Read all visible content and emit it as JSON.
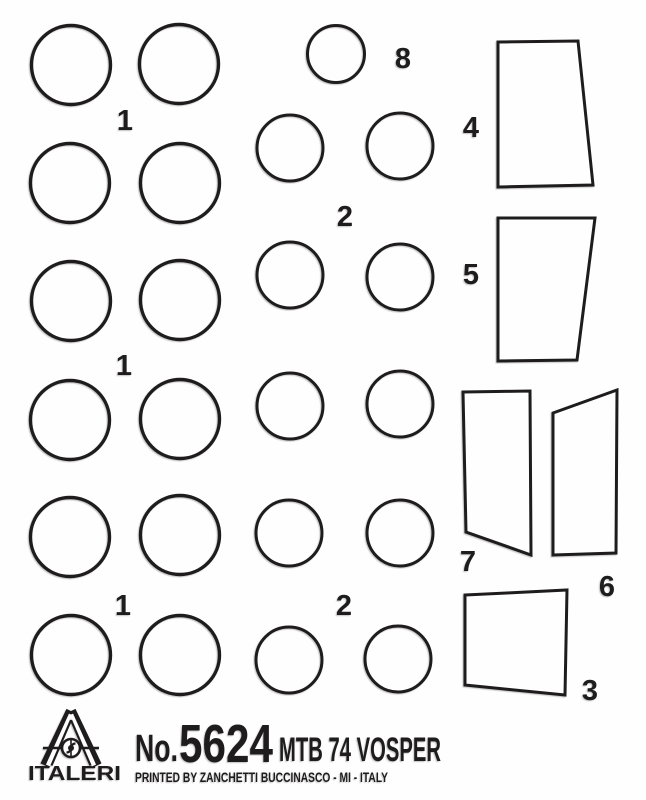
{
  "sheet": {
    "title": "Italeri decal / clear parts placement sheet",
    "background_color": "#fefefe",
    "ink_color": "#1e1c1d"
  },
  "part_labels": [
    {
      "text": "1",
      "x": 125,
      "y": 130
    },
    {
      "text": "1",
      "x": 124,
      "y": 375
    },
    {
      "text": "1",
      "x": 123,
      "y": 615
    },
    {
      "text": "2",
      "x": 345,
      "y": 226
    },
    {
      "text": "2",
      "x": 344,
      "y": 615
    },
    {
      "text": "8",
      "x": 403,
      "y": 68
    },
    {
      "text": "4",
      "x": 471,
      "y": 137
    },
    {
      "text": "5",
      "x": 471,
      "y": 284
    },
    {
      "text": "7",
      "x": 468,
      "y": 571
    },
    {
      "text": "6",
      "x": 607,
      "y": 596
    },
    {
      "text": "3",
      "x": 590,
      "y": 700
    }
  ],
  "circles": [
    {
      "part": "1",
      "cx": 71,
      "cy": 65,
      "r": 39.5,
      "sw": 3.4
    },
    {
      "part": "1",
      "cx": 179,
      "cy": 64,
      "r": 39.5,
      "sw": 3.4
    },
    {
      "part": "1",
      "cx": 70,
      "cy": 183,
      "r": 39.5,
      "sw": 3.4
    },
    {
      "part": "1",
      "cx": 180,
      "cy": 183,
      "r": 39.5,
      "sw": 3.4
    },
    {
      "part": "1",
      "cx": 71,
      "cy": 301,
      "r": 39.5,
      "sw": 3.4
    },
    {
      "part": "1",
      "cx": 180,
      "cy": 300,
      "r": 39.5,
      "sw": 3.4
    },
    {
      "part": "1",
      "cx": 70,
      "cy": 420,
      "r": 39.5,
      "sw": 3.4
    },
    {
      "part": "1",
      "cx": 180,
      "cy": 419,
      "r": 39.5,
      "sw": 3.4
    },
    {
      "part": "1",
      "cx": 70,
      "cy": 537,
      "r": 39.5,
      "sw": 3.4
    },
    {
      "part": "1",
      "cx": 180,
      "cy": 535,
      "r": 39.5,
      "sw": 3.4
    },
    {
      "part": "1",
      "cx": 71,
      "cy": 655,
      "r": 39.5,
      "sw": 3.4
    },
    {
      "part": "1",
      "cx": 180,
      "cy": 655,
      "r": 39.5,
      "sw": 3.4
    },
    {
      "part": "2",
      "cx": 290,
      "cy": 148,
      "r": 33,
      "sw": 3
    },
    {
      "part": "2",
      "cx": 400,
      "cy": 146,
      "r": 33,
      "sw": 3
    },
    {
      "part": "2",
      "cx": 290,
      "cy": 275,
      "r": 33,
      "sw": 3
    },
    {
      "part": "2",
      "cx": 400,
      "cy": 277,
      "r": 33,
      "sw": 3
    },
    {
      "part": "2",
      "cx": 290,
      "cy": 406,
      "r": 33,
      "sw": 3
    },
    {
      "part": "2",
      "cx": 400,
      "cy": 404,
      "r": 33,
      "sw": 3
    },
    {
      "part": "2",
      "cx": 289,
      "cy": 533,
      "r": 33,
      "sw": 3
    },
    {
      "part": "2",
      "cx": 400,
      "cy": 533,
      "r": 33,
      "sw": 3
    },
    {
      "part": "2",
      "cx": 289,
      "cy": 660,
      "r": 33,
      "sw": 3
    },
    {
      "part": "2",
      "cx": 398,
      "cy": 659,
      "r": 33,
      "sw": 3
    },
    {
      "part": "8",
      "cx": 336,
      "cy": 54,
      "r": 28.5,
      "sw": 3
    }
  ],
  "quads": [
    {
      "part": "4",
      "points": [
        [
          498,
          42
        ],
        [
          578,
          41
        ],
        [
          593,
          185
        ],
        [
          498,
          187
        ]
      ]
    },
    {
      "part": "5",
      "points": [
        [
          498,
          218
        ],
        [
          595,
          218
        ],
        [
          577,
          360
        ],
        [
          498,
          361
        ]
      ]
    },
    {
      "part": "7",
      "points": [
        [
          463,
          392
        ],
        [
          530,
          391
        ],
        [
          531,
          555
        ],
        [
          466,
          532
        ]
      ]
    },
    {
      "part": "6",
      "points": [
        [
          553,
          413
        ],
        [
          617,
          390
        ],
        [
          616,
          553
        ],
        [
          553,
          555
        ]
      ]
    },
    {
      "part": "3",
      "points": [
        [
          465,
          595
        ],
        [
          567,
          590
        ],
        [
          565,
          695
        ],
        [
          465,
          685
        ]
      ]
    }
  ],
  "footer": {
    "brand": "ITALERI",
    "number_prefix": "No.",
    "kit_number": "5624",
    "kit_name": "MTB 74 VOSPER",
    "printed_line": "PRINTED BY ZANCHETTI BUCCINASCO - MI - ITALY"
  },
  "footer_text_layout": [
    {
      "name": "brand-wordmark",
      "bind": "brand",
      "x": 28,
      "y": 780,
      "size": 20,
      "length": 93
    },
    {
      "name": "kit-number-prefix",
      "bind": "number_prefix",
      "x": 135,
      "y": 761,
      "size": 38,
      "length": 43
    },
    {
      "name": "kit-number",
      "bind": "kit_number",
      "x": 179,
      "y": 762,
      "size": 54,
      "length": 94
    },
    {
      "name": "kit-name",
      "bind": "kit_name",
      "x": 279,
      "y": 761,
      "size": 34,
      "length": 162
    },
    {
      "name": "printed-line",
      "bind": "printed_line",
      "x": 135,
      "y": 782,
      "size": 13.5,
      "length": 253
    }
  ]
}
